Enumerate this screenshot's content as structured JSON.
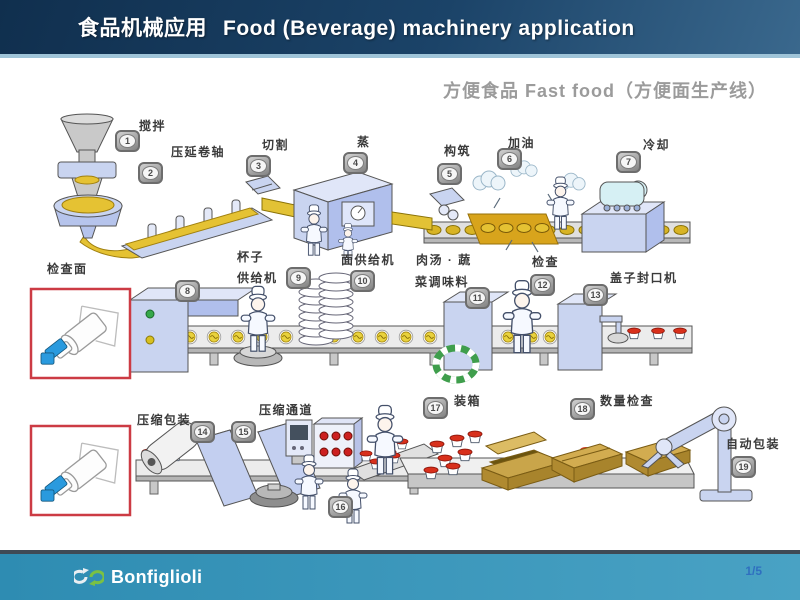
{
  "header": {
    "title_zh": "食品机械应用",
    "title_en": "Food (Beverage) machinery application"
  },
  "subtitle": "方便食品 Fast food（方便面生产线）",
  "stations": [
    {
      "num": "1",
      "label": "搅拌"
    },
    {
      "num": "2",
      "label": "压延卷轴"
    },
    {
      "num": "3",
      "label": "切割"
    },
    {
      "num": "4",
      "label": "蒸"
    },
    {
      "num": "5",
      "label": "构筑"
    },
    {
      "num": "6",
      "label": "加油"
    },
    {
      "num": "7",
      "label": "冷却"
    },
    {
      "num": "8",
      "label": "检查面"
    },
    {
      "num": "9",
      "label": "杯子",
      "label2": "供给机"
    },
    {
      "num": "10",
      "label": "面供给机"
    },
    {
      "num": "11",
      "label": "肉汤 · 蔬",
      "label2": "菜调味料"
    },
    {
      "num": "12",
      "label": "检查"
    },
    {
      "num": "13",
      "label": "盖子封口机"
    },
    {
      "num": "14",
      "label": "压缩包装"
    },
    {
      "num": "15",
      "label": "压缩通道"
    },
    {
      "num": "16",
      "label": ""
    },
    {
      "num": "17",
      "label": "装箱"
    },
    {
      "num": "18",
      "label": "数量检查"
    },
    {
      "num": "19",
      "label": "自动包装"
    }
  ],
  "footer": {
    "brand": "Bonfiglioli",
    "logo_icon": "double-circular-arrows",
    "page": "1/5"
  },
  "colors": {
    "header_navy": "#16395c",
    "header_light": "#3a688d",
    "footer_teal": "#3d9abd",
    "subtitle_gray": "#9b9b9b",
    "inset_border_red": "#cc3b44",
    "machine_blue": "#c9d4f0",
    "noodle_yellow": "#e5c233",
    "lid_red": "#d8301c",
    "box_tan": "#d2ac50",
    "brand_green": "#7ac143",
    "page_number_blue": "#2f6fc0"
  }
}
